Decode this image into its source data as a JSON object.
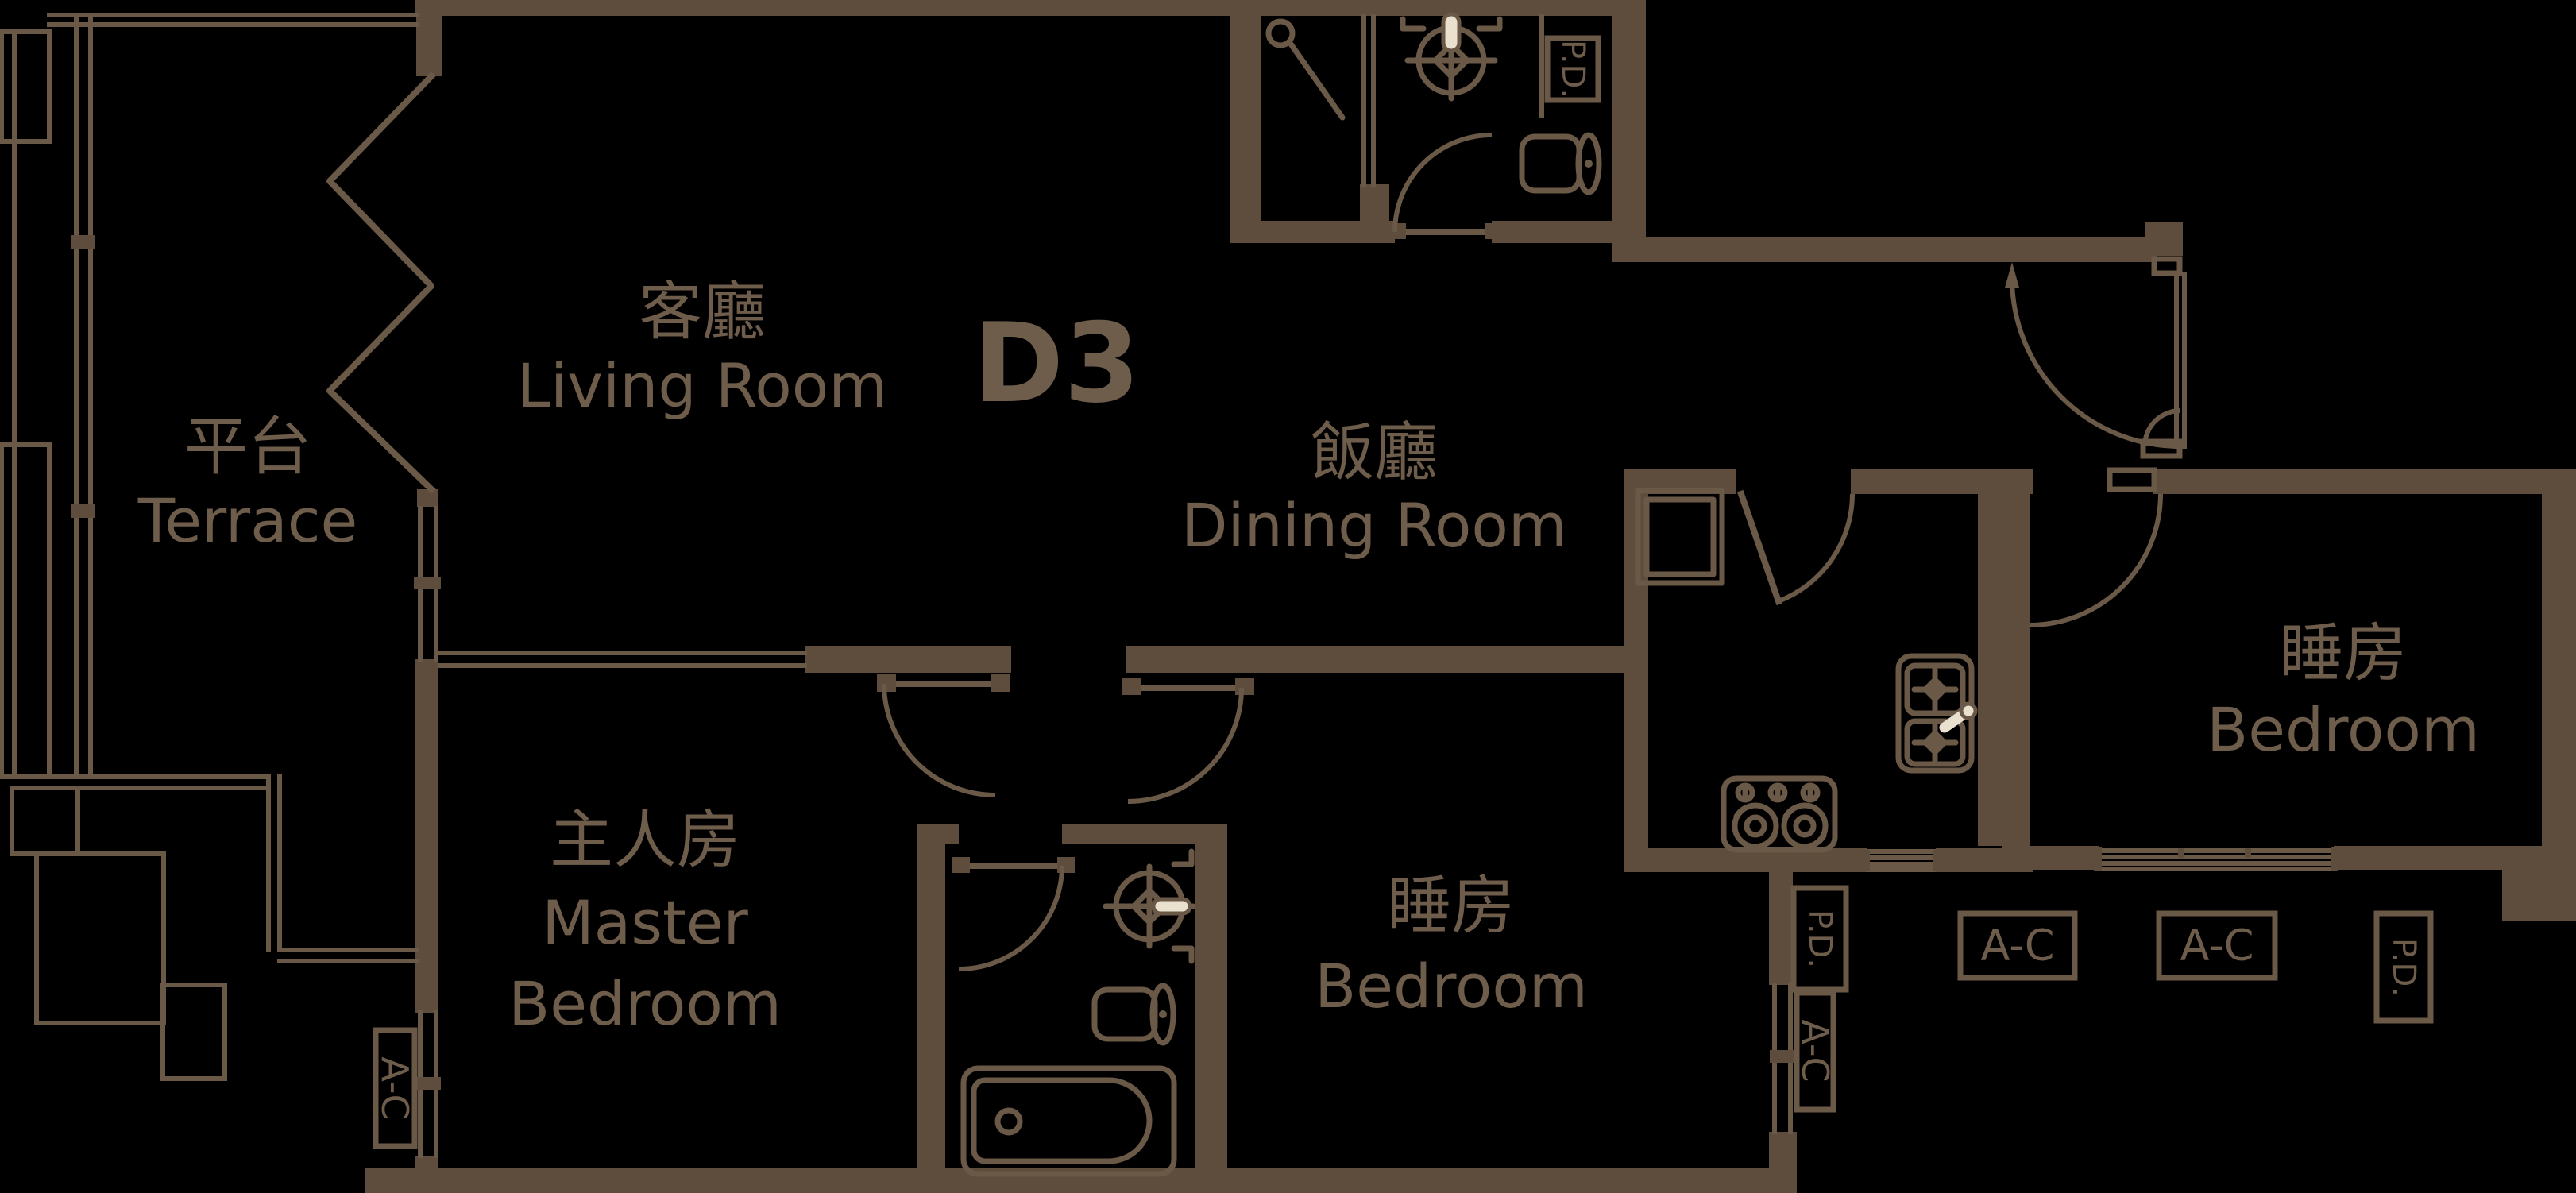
{
  "unit": {
    "label": "D3"
  },
  "colors": {
    "background": "#000000",
    "wall": "#5E4D3D",
    "line": "#6B5948",
    "text": "#6F5D4C",
    "accent_cream": "#E9E0CE"
  },
  "rooms": {
    "living": {
      "zh": "客廳",
      "en": "Living Room"
    },
    "dining": {
      "zh": "飯廳",
      "en": "Dining Room"
    },
    "terrace": {
      "zh": "平台",
      "en": "Terrace"
    },
    "master": {
      "zh": "主人房",
      "en_line1": "Master",
      "en_line2": "Bedroom"
    },
    "bedroom_middle": {
      "zh": "睡房",
      "en": "Bedroom"
    },
    "bedroom_right": {
      "zh": "睡房",
      "en": "Bedroom"
    }
  },
  "equipment": {
    "ac_label": "A-C",
    "pd_label": "P.D."
  }
}
